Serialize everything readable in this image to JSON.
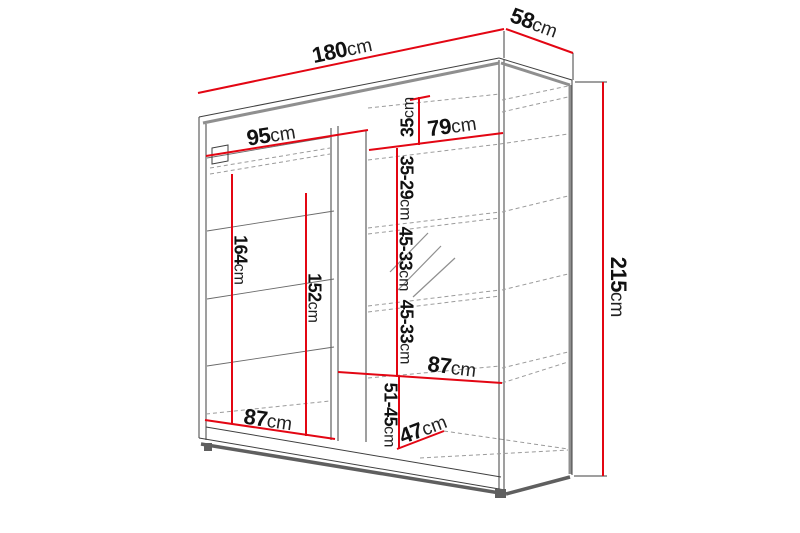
{
  "diagram": {
    "title": "wardrobe-dimension-diagram",
    "unit": "cm",
    "colors": {
      "background": "#ffffff",
      "dimension_red": "#e30613",
      "structure": "#3f3f3f",
      "structure_gray": "#8f8f8f",
      "shadow_gray": "#5f5f5f",
      "dashed_gray": "#9b9b9b",
      "hatch_gray": "#8f8f8f",
      "text": "#111111"
    },
    "dimensions": [
      {
        "name": "total-width",
        "num": "180",
        "unit": "cm",
        "x": 342,
        "y": 50,
        "rotate": -12,
        "size": "lg",
        "line": [
          198,
          93,
          504,
          29
        ]
      },
      {
        "name": "total-depth",
        "num": "58",
        "unit": "cm",
        "x": 534,
        "y": 23,
        "rotate": 20,
        "size": "lg",
        "line": [
          506,
          29,
          573,
          53
        ]
      },
      {
        "name": "total-height",
        "num": "215",
        "unit": "cm",
        "x": 618,
        "y": 287,
        "rotate": 90,
        "size": "lg",
        "line": [
          603,
          82,
          603,
          476
        ]
      },
      {
        "name": "left-inner-width",
        "num": "95",
        "unit": "cm",
        "x": 271,
        "y": 135,
        "rotate": -9,
        "size": "lg",
        "line": [
          206,
          156,
          368,
          130
        ]
      },
      {
        "name": "right-shelf-width",
        "num": "79",
        "unit": "cm",
        "x": 452,
        "y": 126,
        "rotate": -8,
        "size": "lg",
        "line": [
          369,
          150,
          503,
          133
        ]
      },
      {
        "name": "top-shelf-height",
        "num": "35",
        "unit": "cm",
        "x": 408,
        "y": 117,
        "rotate": -90,
        "size": "md",
        "line": [
          419,
          97,
          419,
          145
        ]
      },
      {
        "name": "shelf-gap-1",
        "num": "35-29",
        "unit": "cm",
        "x": 406,
        "y": 188,
        "rotate": 90,
        "size": "md",
        "line": [
          397,
          148,
          397,
          377
        ]
      },
      {
        "name": "shelf-gap-2",
        "num": "45-33",
        "unit": "cm",
        "x": 405,
        "y": 259,
        "rotate": 90,
        "size": "md",
        "line": null
      },
      {
        "name": "shelf-gap-3",
        "num": "45-33",
        "unit": "cm",
        "x": 406,
        "y": 332,
        "rotate": 90,
        "size": "md",
        "line": null
      },
      {
        "name": "mid-shelf-width",
        "num": "87",
        "unit": "cm",
        "x": 452,
        "y": 367,
        "rotate": 7,
        "size": "lg",
        "line": [
          338,
          372,
          502,
          383
        ]
      },
      {
        "name": "bottom-gap",
        "num": "51-45",
        "unit": "cm",
        "x": 390,
        "y": 415,
        "rotate": 90,
        "size": "md",
        "line": [
          399,
          377,
          399,
          449
        ]
      },
      {
        "name": "bottom-depth",
        "num": "47",
        "unit": "cm",
        "x": 423,
        "y": 429,
        "rotate": -21,
        "size": "lg",
        "line": [
          397,
          449,
          444,
          431
        ]
      },
      {
        "name": "bottom-shelf-width",
        "num": "87",
        "unit": "cm",
        "x": 268,
        "y": 420,
        "rotate": 8,
        "size": "lg",
        "line": [
          205,
          420,
          335,
          439
        ]
      },
      {
        "name": "left-hanging-height",
        "num": "164",
        "unit": "cm",
        "x": 240,
        "y": 260,
        "rotate": 90,
        "size": "md",
        "line": [
          232,
          174,
          232,
          424
        ]
      },
      {
        "name": "left-inner-height",
        "num": "152",
        "unit": "cm",
        "x": 314,
        "y": 298,
        "rotate": 90,
        "size": "md",
        "line": [
          306,
          193,
          306,
          436
        ]
      }
    ],
    "red_ticks": [
      [
        410,
        100,
        430,
        96
      ]
    ],
    "extension_lines": [
      [
        504,
        31,
        504,
        58
      ],
      [
        573,
        53,
        573,
        80
      ],
      [
        575,
        82,
        607,
        82
      ],
      [
        574,
        476,
        607,
        476
      ]
    ],
    "structure_lines": [
      [
        199,
        117,
        499,
        58
      ],
      [
        199,
        117,
        199,
        438
      ],
      [
        206,
        124,
        206,
        440
      ],
      [
        499,
        58,
        572,
        80
      ],
      [
        499,
        60,
        499,
        490
      ],
      [
        504,
        60,
        504,
        491
      ],
      [
        572,
        80,
        572,
        475
      ],
      [
        199,
        438,
        505,
        490
      ],
      [
        206,
        427,
        501,
        477
      ],
      [
        331,
        128,
        331,
        440
      ],
      [
        338,
        126,
        338,
        441
      ],
      [
        366,
        130,
        366,
        442
      ]
    ],
    "interior_solid_lines": [
      [
        207,
        158,
        330,
        137
      ],
      [
        207,
        231,
        334,
        211
      ],
      [
        207,
        299,
        334,
        279
      ],
      [
        207,
        366,
        334,
        347
      ]
    ],
    "gray_thick_lines": [
      [
        203,
        123,
        499,
        63
      ],
      [
        501,
        63,
        570,
        85
      ],
      [
        570,
        85,
        570,
        474
      ]
    ],
    "shadow_thick_lines": [
      [
        201,
        444,
        506,
        494
      ],
      [
        506,
        494,
        570,
        477
      ]
    ],
    "dashed_lines": [
      [
        210,
        168,
        330,
        148
      ],
      [
        210,
        174,
        330,
        154
      ],
      [
        206,
        414,
        330,
        401
      ],
      [
        368,
        108,
        500,
        94
      ],
      [
        368,
        160,
        500,
        144
      ],
      [
        500,
        144,
        568,
        134
      ],
      [
        368,
        228,
        500,
        212
      ],
      [
        368,
        234,
        500,
        218
      ],
      [
        502,
        212,
        568,
        196
      ],
      [
        368,
        306,
        500,
        290
      ],
      [
        368,
        312,
        500,
        296
      ],
      [
        502,
        290,
        568,
        274
      ],
      [
        368,
        378,
        500,
        366
      ],
      [
        502,
        368,
        568,
        352
      ],
      [
        502,
        383,
        568,
        362
      ],
      [
        444,
        431,
        568,
        449
      ],
      [
        420,
        458,
        568,
        450
      ],
      [
        502,
        100,
        568,
        86
      ],
      [
        502,
        112,
        568,
        97
      ]
    ],
    "hatch_lines": [
      [
        390,
        272,
        428,
        233
      ],
      [
        398,
        290,
        441,
        246
      ],
      [
        413,
        297,
        455,
        258
      ]
    ],
    "bracket_polygon": "212,148 228,145 228,161 212,164",
    "feet": [
      [
        204,
        443,
        8,
        8
      ],
      [
        495,
        489,
        11,
        9
      ]
    ]
  }
}
